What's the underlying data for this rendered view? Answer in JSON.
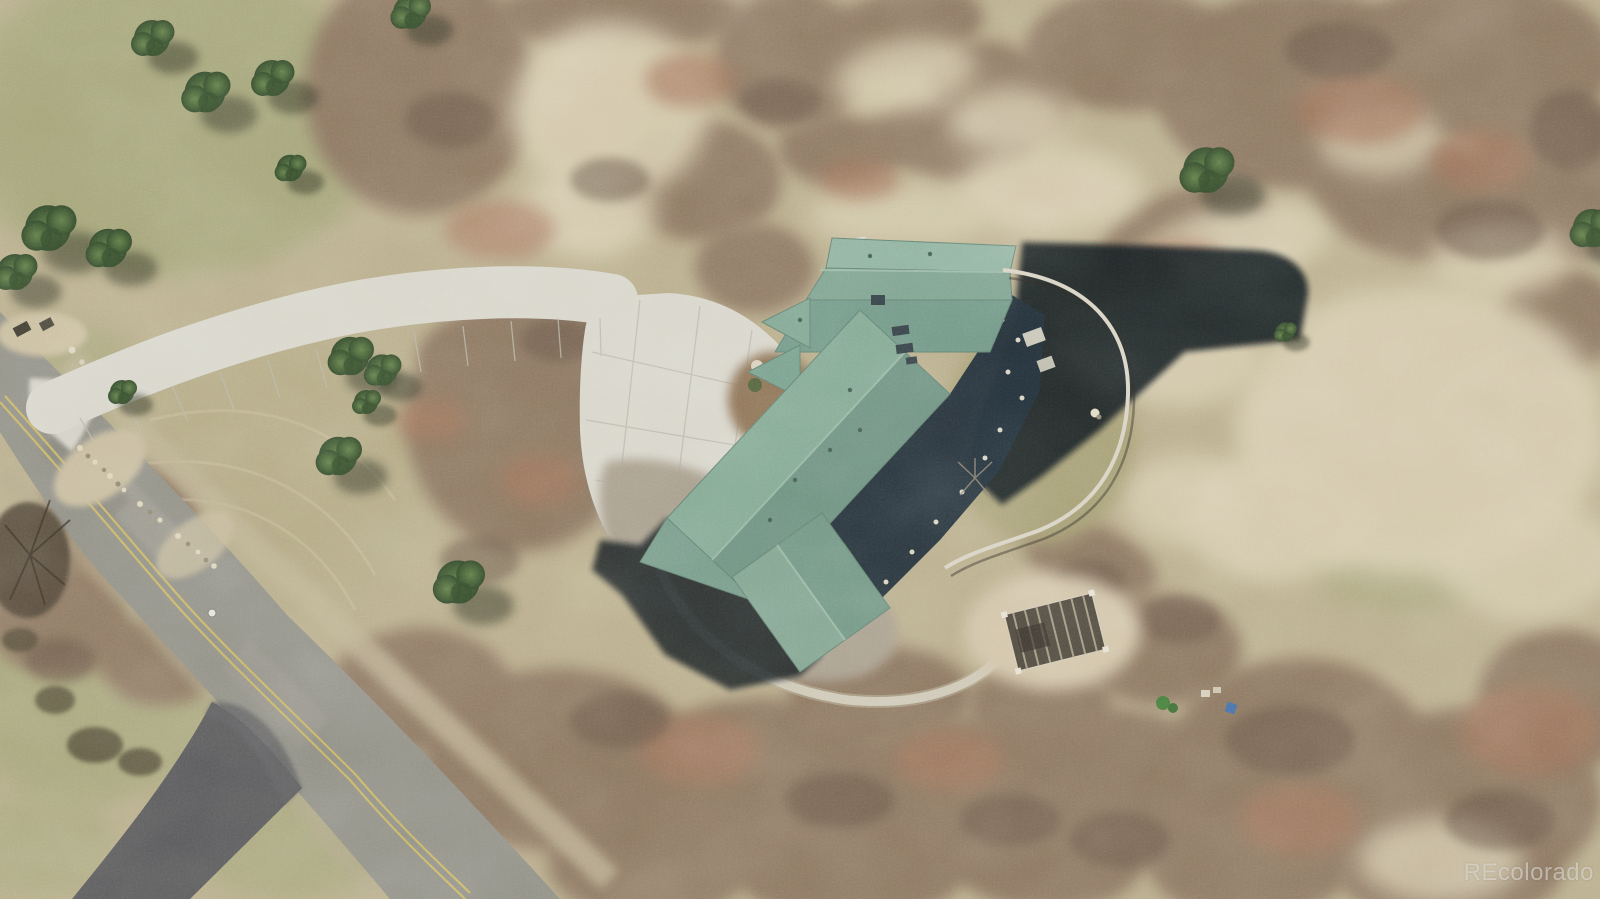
{
  "meta": {
    "type": "aerial-photograph",
    "description": "Overhead drone view of a rural residential property: large house with teal shingle roof casting a long shadow east, sweeping concrete driveway and motor court, two-lane road with double yellow centerline along the left, dark asphalt side driveway, curved backyard fence enclosing a lawn, pergola on a dirt clearing, dry grass fields, brown leafless scrub-oak thickets and scattered evergreen trees"
  },
  "watermark": {
    "text": "REcolorado"
  },
  "palette": {
    "dry_grass": "#b9ae8e",
    "warm_grass": "#b3ab87",
    "green_grass": "#9da374",
    "lawn": "#a49e74",
    "sand": "#d7cdb2",
    "scrub": "#8a7561",
    "scrub_dark": "#5e4d40",
    "scrub_rust": "#a2735a",
    "road_asphalt": "#8f8f88",
    "road_patch": "#a3a29a",
    "lane_yellow": "#c9b666",
    "asphalt_drive": "#54555a",
    "concrete": "#d9d8d0",
    "concrete_joint": "#b8b8ae",
    "gravel_bed": "#a79e8f",
    "riprap": "#c7bca0",
    "roof_light": "#8db2a2",
    "roof_mid": "#7ba292",
    "roof_dark": "#6a9183",
    "ridge_light": "#9fc0ae",
    "cast_shadow": "#10161c",
    "deck_navy": "#1b2836",
    "tree_green": "#3f5c33",
    "turf_green": "#4e8f3c",
    "fence_light": "#d8d4c8",
    "pergola_wood": "#4a443c",
    "dirt_pad": "#d3c6ad",
    "blue_object": "#3f6fae",
    "white_marker": "#e6e6df"
  },
  "scene": {
    "features": [
      "two-lane road with double yellow centerline, lower left",
      "dark asphalt side driveway branching southwest",
      "curved light concrete driveway with expansion joints",
      "concrete motor court with landscape island, shrubs and boulders",
      "mailbox pad at driveway entrance with riprap rock band",
      "house with complex teal shingle roof and cross gables",
      "skylights and roof vents",
      "long cast shadow east of house",
      "navy shaded deck with light posts and steps",
      "curved light fence enclosing olive backyard lawn",
      "white boulder inside backyard",
      "gravel mulch bed wrapping south side of house",
      "green artificial turf patch at deck",
      "curved concrete garden path to pergola",
      "slatted pergola on bare dirt clearing",
      "small green utility vehicle and blue object near scrub",
      "white pavement marker dot on road",
      "dry grass field inside driveway loop with conifer trees",
      "extensive leafless scrub-oak thickets",
      "scattered evergreen pine trees with shadows to southeast",
      "sandy pale soil patches",
      "burnt leafless tree beside road"
    ]
  }
}
